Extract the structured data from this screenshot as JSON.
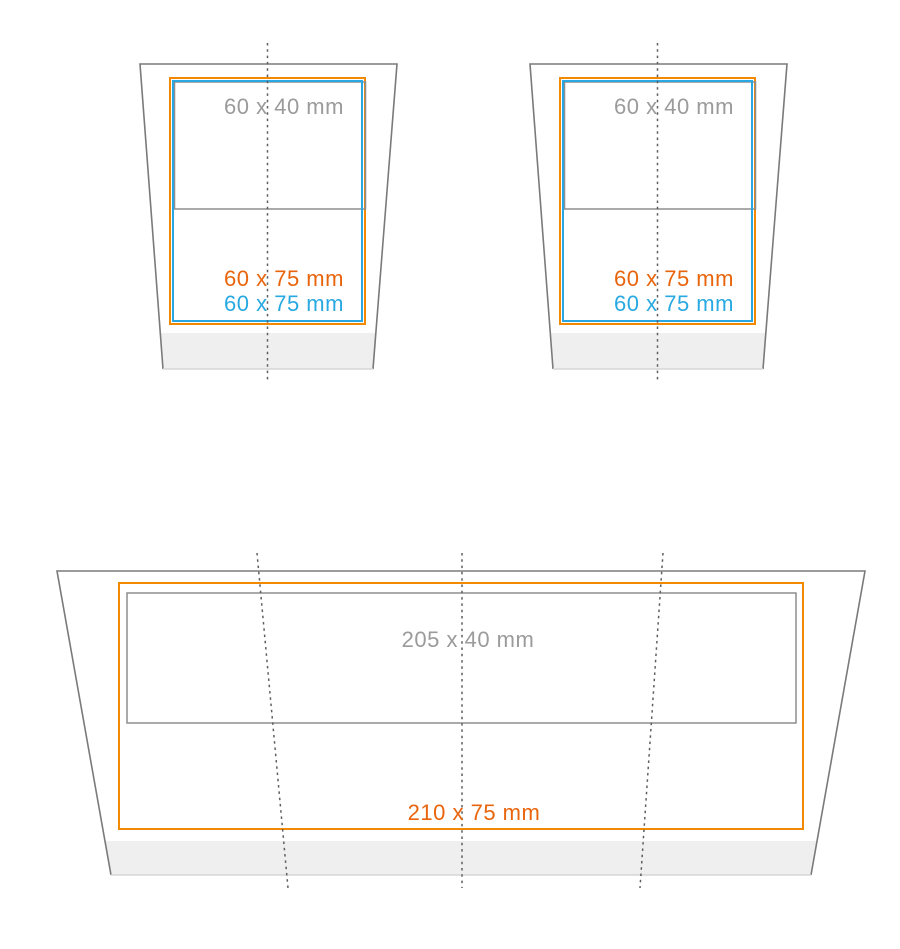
{
  "colors": {
    "orange": "#F18A00",
    "orange_text": "#E9650D",
    "blue": "#2AA7E0",
    "blue_text": "#29A9E1",
    "gray_text": "#9B9B9B",
    "outline_gray": "#7A7A7A",
    "inner_rect_gray": "#8D8D8D",
    "base_band_fill": "#EFEFEF"
  },
  "cups": [
    {
      "top_area_label": "60 x 40 mm",
      "print_area_label_orange": "60 x 75 mm",
      "print_area_label_blue": "60 x 75 mm"
    },
    {
      "top_area_label": "60 x 40 mm",
      "print_area_label_orange": "60 x 75 mm",
      "print_area_label_blue": "60 x 75 mm"
    }
  ],
  "wrap": {
    "top_area_label": "205 x 40 mm",
    "print_area_label_orange": "210 x 75 mm"
  }
}
